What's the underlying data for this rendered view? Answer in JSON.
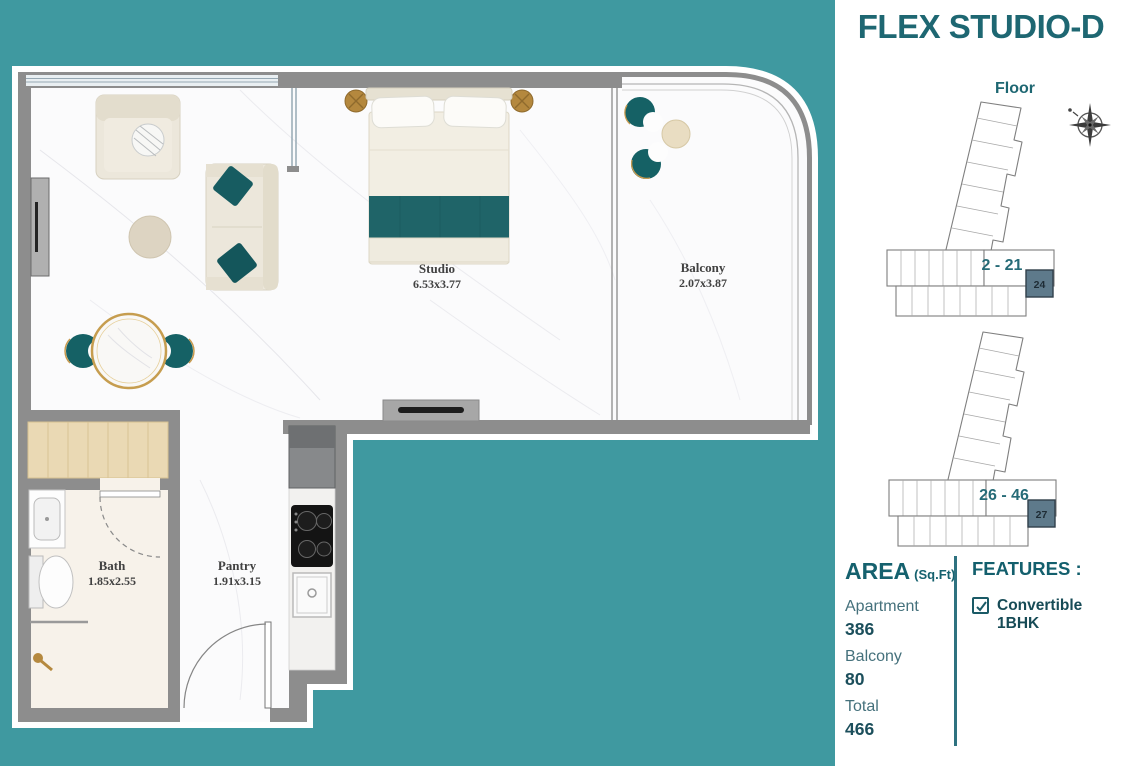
{
  "brochure": {
    "title": "FLEX STUDIO-D",
    "floor_section": {
      "label": "Floor",
      "stacks": [
        {
          "floors": "2 - 21",
          "unit": "24"
        },
        {
          "floors": "26 - 46",
          "unit": "27"
        }
      ]
    },
    "area": {
      "heading": "AREA",
      "unit_suffix": "(Sq.Ft)",
      "rows": [
        {
          "label": "Apartment",
          "value": "386"
        },
        {
          "label": "Balcony",
          "value": "80"
        },
        {
          "label": "Total",
          "value": "466"
        }
      ]
    },
    "features": {
      "heading": "FEATURES :",
      "items": [
        {
          "label": "Convertible 1BHK",
          "checked": true
        }
      ]
    }
  },
  "floorplan": {
    "rooms": [
      {
        "name": "Studio",
        "dims": "6.53x3.77"
      },
      {
        "name": "Balcony",
        "dims": "2.07x3.87"
      },
      {
        "name": "Bath",
        "dims": "1.85x2.55"
      },
      {
        "name": "Pantry",
        "dims": "1.91x3.15"
      }
    ]
  },
  "colors": {
    "background_teal": "#3F99A0",
    "accent_teal_dark": "#1E6772",
    "furniture_teal": "#1F6468",
    "wall_gray": "#8D8D8D",
    "gold": "#B5893F",
    "unit_highlight": "#5E7A8B"
  }
}
